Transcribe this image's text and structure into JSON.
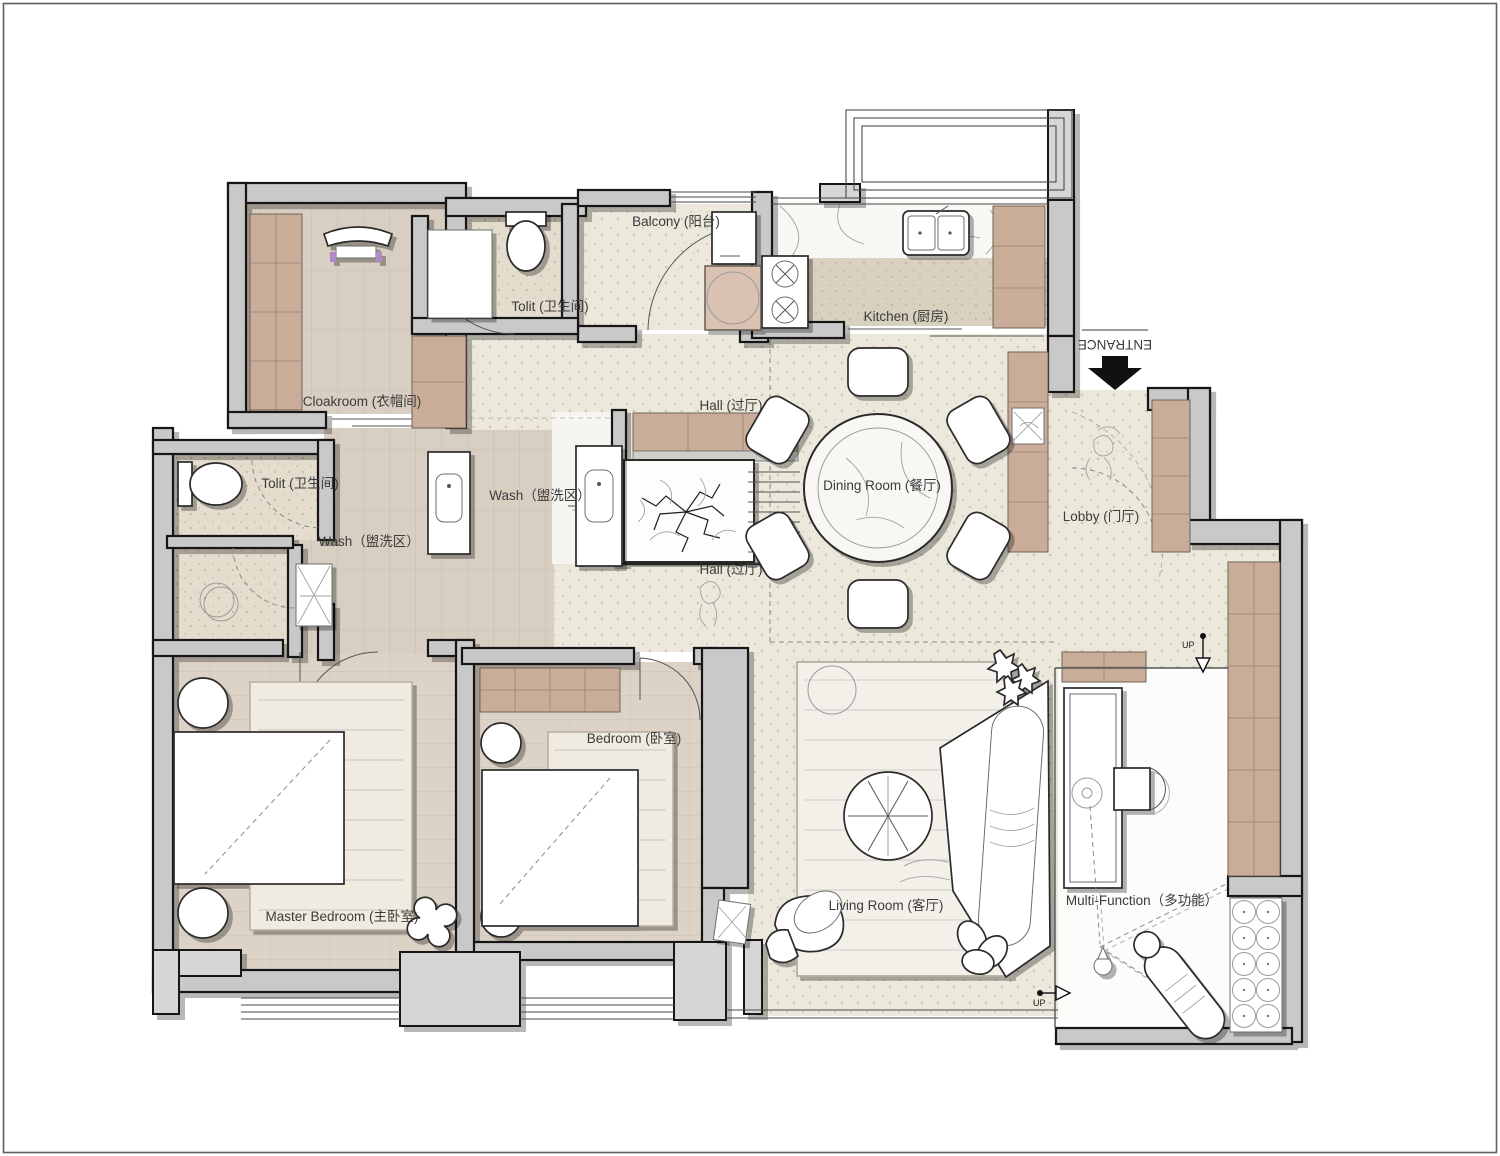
{
  "plan_type": "apartment-floor-plan",
  "rooms": {
    "balcony": {
      "label": "Balcony (阳台)"
    },
    "tolit_top": {
      "label": "Tolit (卫生间)"
    },
    "kitchen": {
      "label": "Kitchen (厨房)"
    },
    "cloakroom": {
      "label": "Cloakroom (衣帽间)"
    },
    "hall_upper": {
      "label": "Hall (过厅)"
    },
    "wash_center": {
      "label": "Wash（盥洗区）"
    },
    "dining_room": {
      "label": "Dining Room (餐厅)"
    },
    "lobby": {
      "label": "Lobby (门厅)"
    },
    "tolit_left": {
      "label": "Tolit (卫生间)"
    },
    "wash_left": {
      "label": "Wash（盥洗区）"
    },
    "hall_lower": {
      "label": "Hall (过厅)"
    },
    "master_bedroom": {
      "label": "Master Bedroom (主卧室)"
    },
    "bedroom": {
      "label": "Bedroom (卧室)"
    },
    "living_room": {
      "label": "Living Room (客厅)"
    },
    "multi_function": {
      "label": "Multi-Function（多功能）"
    }
  },
  "markers": {
    "entrance": "ENTRANCE",
    "up_top": "UP",
    "up_bottom": "UP"
  },
  "colors": {
    "wall_fill": "#c9c9c9",
    "wall_stroke": "#161616",
    "wood_floor": "#d9cec2",
    "wood_cabinet": "#c9ad99",
    "terrazzo_floor": "#ece8dc",
    "bath_floor": "#e4ddcd",
    "marble": "#f8f7f4",
    "label_text": "#3b3b3b",
    "entrance_arrow": "#111111"
  }
}
